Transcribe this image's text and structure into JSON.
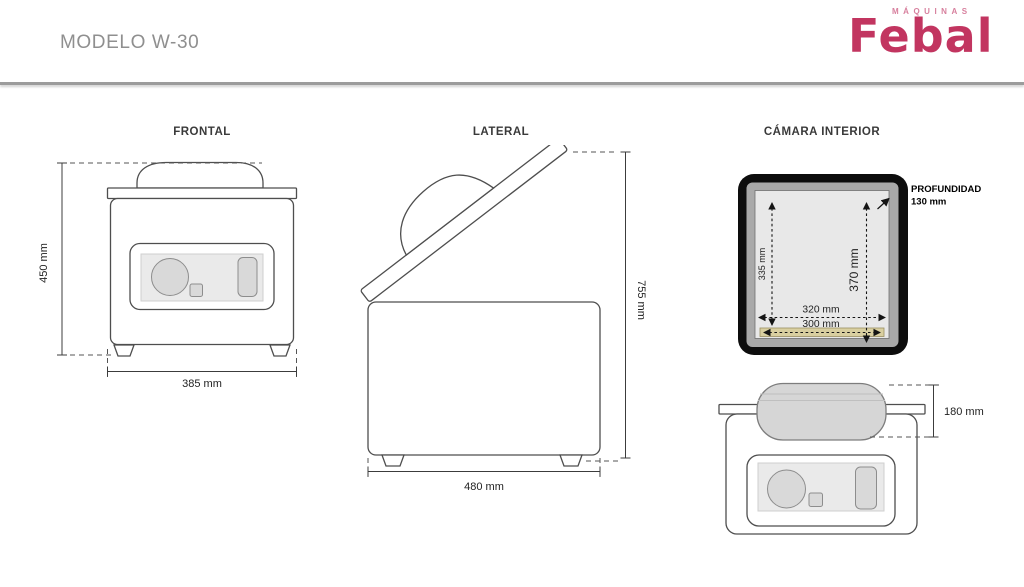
{
  "header": {
    "title": "MODELO W-30"
  },
  "logo": {
    "tagline": "MÁQUINAS",
    "brand": "Febal",
    "brand_color": "#c23560",
    "tagline_color": "#d77f9d"
  },
  "views": {
    "frontal": {
      "title": "FRONTAL",
      "height": "450 mm",
      "width": "385 mm"
    },
    "lateral": {
      "title": "LATERAL",
      "height": "755 mm",
      "depth": "480 mm"
    },
    "chamber": {
      "title": "CÁMARA INTERIOR",
      "inner_height_left": "335 mm",
      "inner_height_right": "370 mm",
      "inner_width": "320 mm",
      "seal_bar_width": "300 mm",
      "depth_label": "PROFUNDIDAD",
      "depth_value": "130 mm"
    },
    "rear": {
      "lid_height": "180 mm"
    }
  },
  "colors": {
    "frame_black": "#0d0d0d",
    "seal_bar_tan": "#d9cfa0",
    "lid_gray": "#d6d6d6",
    "line_gray": "#4e4e4e",
    "divider_gray": "#9c9c9c"
  }
}
